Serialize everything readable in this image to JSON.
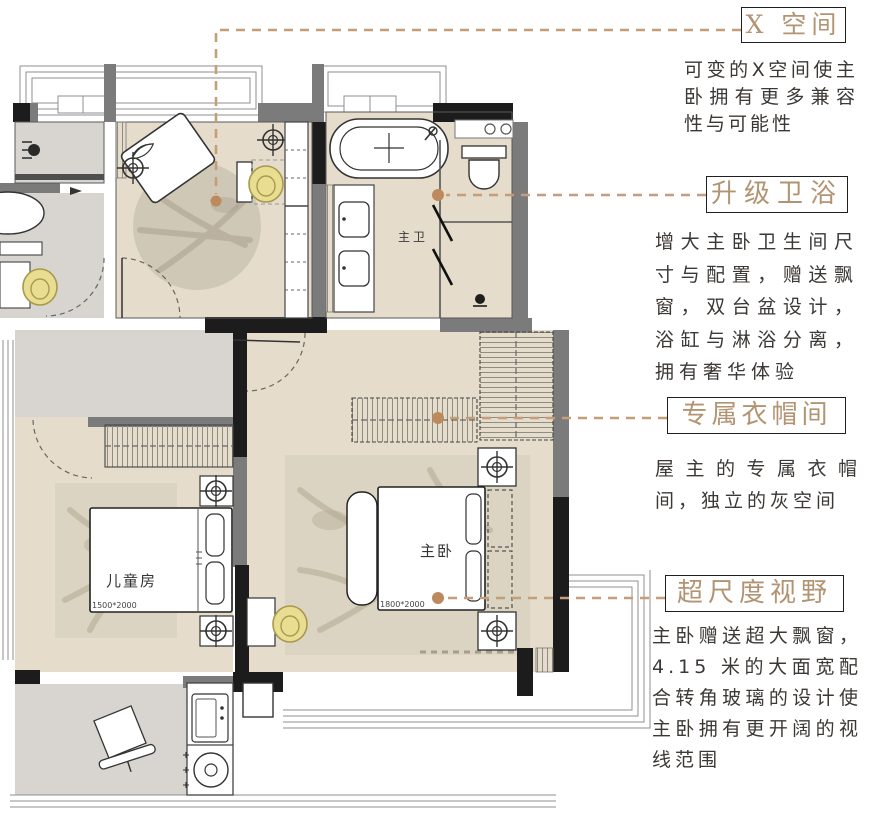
{
  "palette": {
    "accent_title": "#b39472",
    "leader_line": "#c49e78",
    "leader_dot": "#bd8a5e",
    "wall_dark": "#1c1c1c",
    "wall_gray": "#7b7b7b",
    "floor_beige": "#e6dccb",
    "floor_gray": "#d8d5d0",
    "rug_tone": "#d2cbba",
    "highlight_yellow": "#e9dd92"
  },
  "annotations": {
    "items": [
      {
        "title": "X 空间",
        "desc": "可变的X空间使主卧拥有更多兼容性与可能性"
      },
      {
        "title": "升级卫浴",
        "desc": "增大主卧卫生间尺寸与配置，赠送飘窗，双台盆设计，浴缸与淋浴分离，拥有奢华体验"
      },
      {
        "title": "专属衣帽间",
        "desc": "屋主的专属衣帽间，独立的灰空间"
      },
      {
        "title": "超尺度视野",
        "desc": "主卧赠送超大飘窗，4.15 米的大面宽配合转角玻璃的设计使主卧拥有更开阔的视线范围"
      }
    ]
  },
  "floorplan": {
    "rooms": [
      {
        "label": "主卫",
        "dimension": ""
      },
      {
        "label": "儿童房",
        "dimension": "1500*2000"
      },
      {
        "label": "主卧",
        "dimension": "1800*2000"
      }
    ]
  }
}
